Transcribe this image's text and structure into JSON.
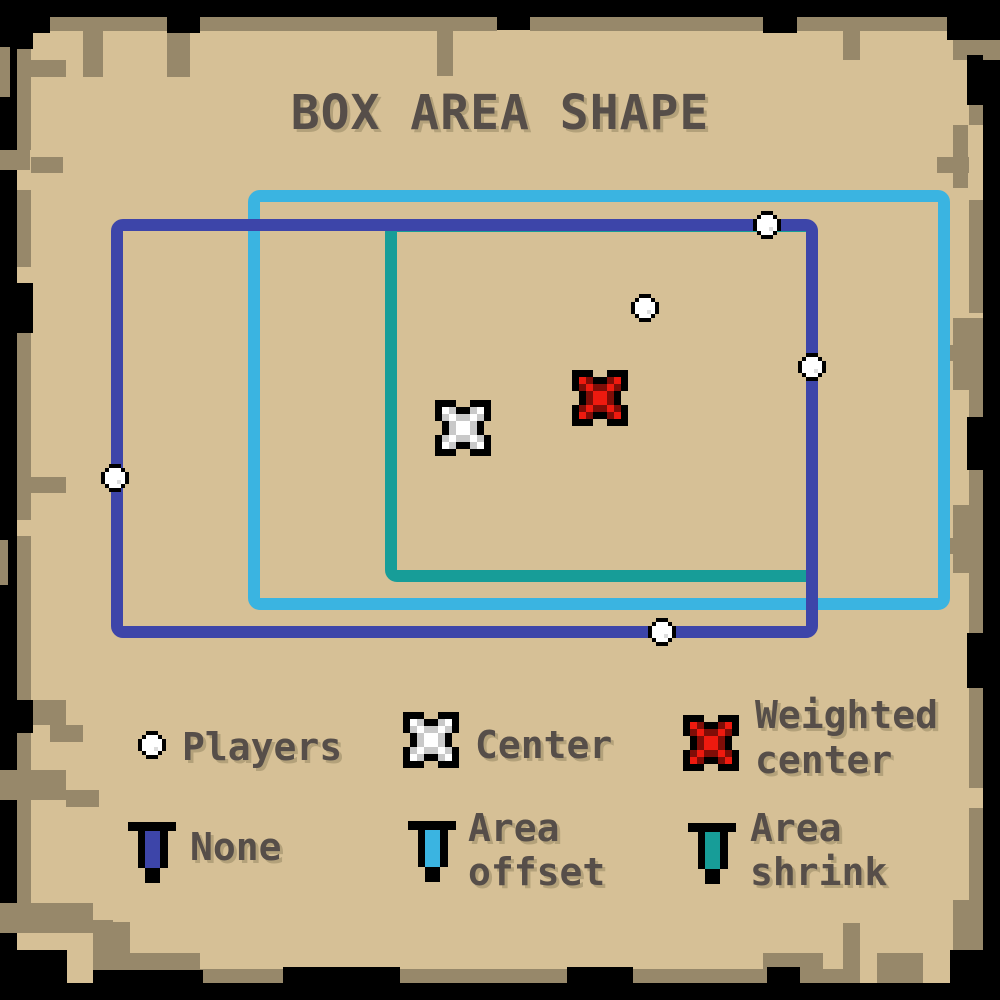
{
  "title": "BOX AREA SHAPE",
  "colors": {
    "background": "#000000",
    "parchment": "#d6c096",
    "border_trim_brown": "#97886a",
    "text": "#564e49",
    "text_shadow": "#b3a17a",
    "none_blue": "#3d45a9",
    "offset_cyan": "#3ab4e1",
    "shrink_teal": "#179d98",
    "marker_red": "#ee1a0f",
    "marker_red_dark": "#7f0d07",
    "marker_white": "#ffffff",
    "marker_gray": "#c9c9c9"
  },
  "plot": {
    "boxes": [
      {
        "id": "area-shrink",
        "x": 385,
        "y": 220,
        "w": 433,
        "h": 362,
        "color": "#179d98"
      },
      {
        "id": "area-offset",
        "x": 248,
        "y": 190,
        "w": 702,
        "h": 420,
        "color": "#3ab4e1"
      },
      {
        "id": "none",
        "x": 111,
        "y": 219,
        "w": 707,
        "h": 419,
        "color": "#3d45a9"
      }
    ],
    "players": [
      [
        115,
        478
      ],
      [
        767,
        225
      ],
      [
        645,
        308
      ],
      [
        812,
        367
      ],
      [
        662,
        632
      ]
    ],
    "center": [
      463,
      428
    ],
    "weighted_center": [
      600,
      398
    ]
  },
  "legend": {
    "markers": [
      {
        "id": "players",
        "lines": [
          "Players"
        ]
      },
      {
        "id": "center",
        "lines": [
          "Center"
        ]
      },
      {
        "id": "weighted-center",
        "lines": [
          "Weighted",
          "center"
        ]
      }
    ],
    "areas": [
      {
        "id": "none",
        "lines": [
          "None"
        ],
        "color": "#3d45a9"
      },
      {
        "id": "area-offset",
        "lines": [
          "Area",
          "offset"
        ],
        "color": "#3ab4e1"
      },
      {
        "id": "area-shrink",
        "lines": [
          "Area",
          "shrink"
        ],
        "color": "#179d98"
      }
    ]
  }
}
